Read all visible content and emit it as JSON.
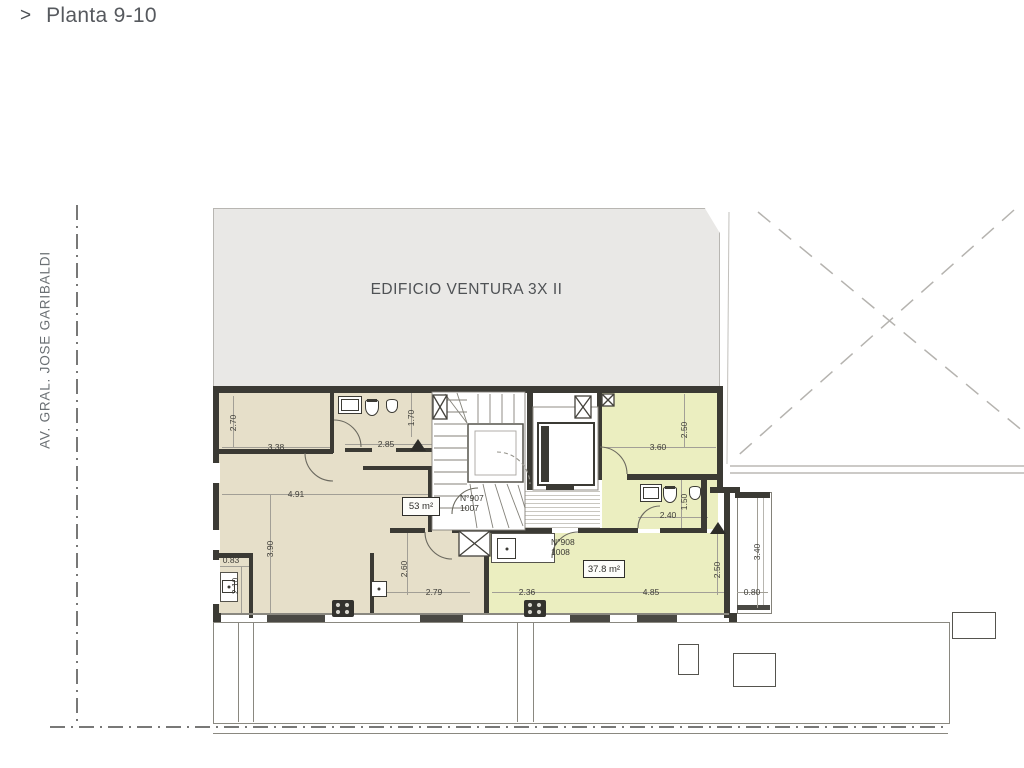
{
  "header": {
    "chevron": ">",
    "title": "Planta 9-10"
  },
  "street_label": "AV. GRAL. JOSE GARIBALDI",
  "neighbor_building_label": "EDIFICIO VENTURA 3X II",
  "units": {
    "left": {
      "number_top": "N°907",
      "number_bottom": "1007",
      "area": "53 m²"
    },
    "right": {
      "number_top": "N°908",
      "number_bottom": "1008",
      "area": "37.8 m²"
    }
  },
  "dims": {
    "d270": "2.70",
    "d338": "3.38",
    "d285": "2.85",
    "d170": "1.70",
    "d491": "4.91",
    "d390": "3.90",
    "d083": "0.83",
    "d210": "2.10",
    "d260": "2.60",
    "d279": "2.79",
    "d360": "3.60",
    "d250a": "2.50",
    "d150": "1.50",
    "d240": "2.40",
    "d250b": "2.50",
    "d485": "4.85",
    "d340": "3.40",
    "d080": "0.80",
    "d236": "2.36"
  },
  "colors": {
    "unit_left_fill": "#e6dfc9",
    "unit_right_fill": "#ebeec0",
    "neighbor_fill": "#e9e8e6",
    "wall": "#3b3a34"
  }
}
